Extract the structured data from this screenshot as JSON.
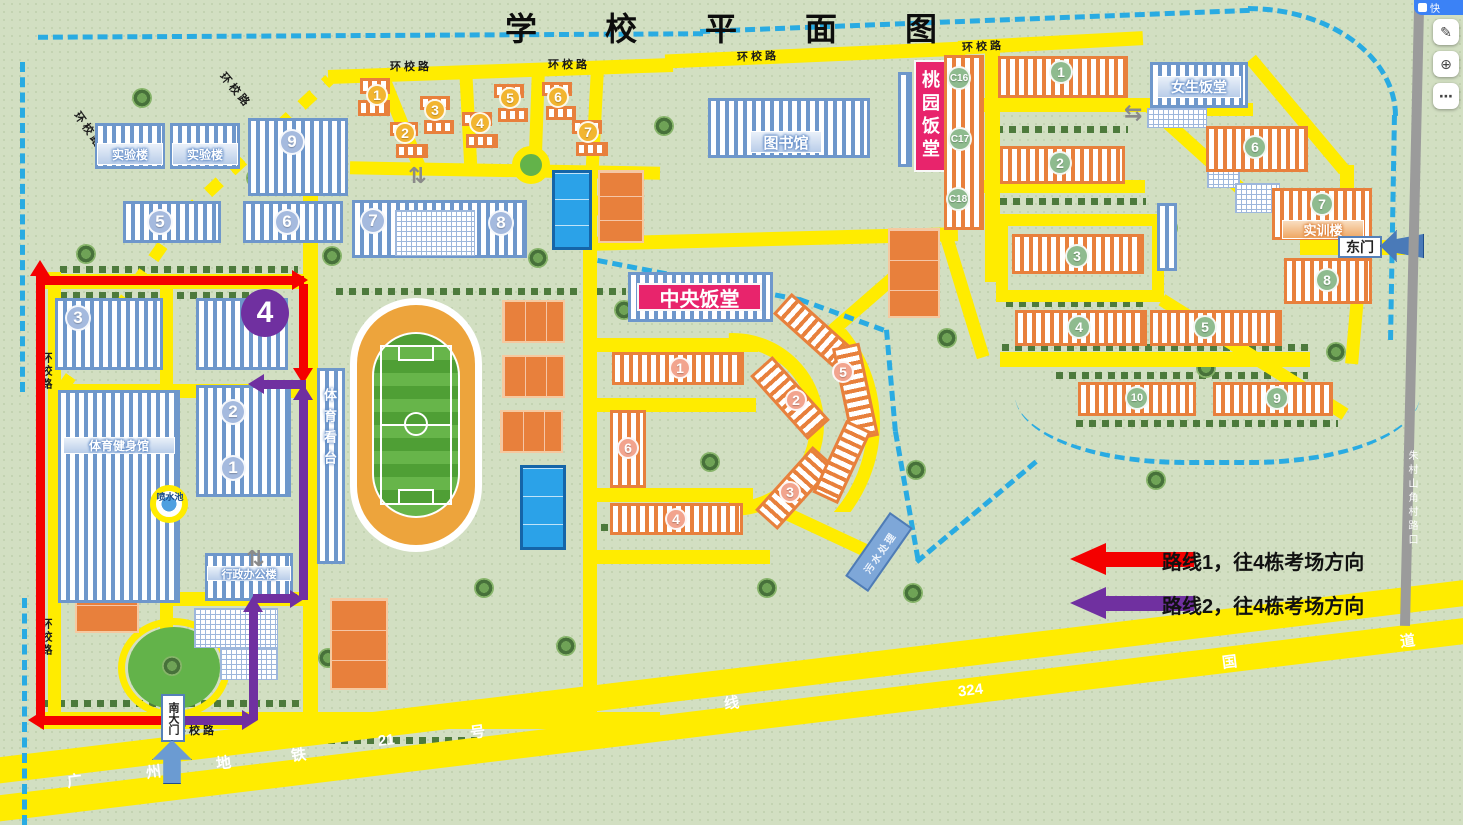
{
  "title": "学校平面图",
  "ring_road": "环校路",
  "toolbar": {
    "pill": "快",
    "edit": "✎",
    "zoom": "⊕",
    "more": "⋯"
  },
  "legend": {
    "route1": "路线1，往4栋考场方向",
    "route2": "路线2，往4栋考场方向"
  },
  "marker4": "4",
  "gates": {
    "east": "东门",
    "south": "南大门"
  },
  "facilities": {
    "library": "图书馆",
    "central_canteen": "中央饭堂",
    "taoyuan_canteen": "桃园饭堂",
    "girls_canteen": "女生饭堂",
    "lab_a": "实验楼",
    "lab_b": "实验楼",
    "training": "实训楼",
    "admin": "行政办公楼",
    "gym": "体育健身馆",
    "stands": "体育看台",
    "fountain": "喷水池",
    "sewage": "污水处理"
  },
  "blue": {
    "b1": "1",
    "b2": "2",
    "b3": "3",
    "b5": "5",
    "b6": "6",
    "b7": "7",
    "b8": "8",
    "b9": "9"
  },
  "gold": [
    "1",
    "2",
    "3",
    "4",
    "5",
    "6",
    "7"
  ],
  "salmon": {
    "c1": "1",
    "c2": "2",
    "c3": "3",
    "c4": "4",
    "c5": "5",
    "c6": "6"
  },
  "cbuild": [
    "C16",
    "C17",
    "C18"
  ],
  "green": {
    "r1": "1",
    "r2": "2",
    "r3": "3",
    "r4": "4",
    "r5": "5",
    "r6": "6",
    "r7": "7",
    "r8": "8",
    "r9": "9",
    "r10": "10"
  },
  "transit": {
    "metro": [
      "广",
      "州",
      "地",
      "铁",
      "21",
      "号",
      "线"
    ],
    "highway": [
      "324",
      "国",
      "道"
    ]
  },
  "boundary_road": "朱村山角村路口",
  "icons": {
    "crosswalk_v": "⇅",
    "crosswalk_h": "⇆"
  },
  "colors": {
    "route1": "#f40000",
    "route2": "#7030a0",
    "road": "#ffec00",
    "boundary": "#29abe2",
    "orange": "#e8803c",
    "blue": "#6e97cb",
    "pink": "#e8246c"
  }
}
